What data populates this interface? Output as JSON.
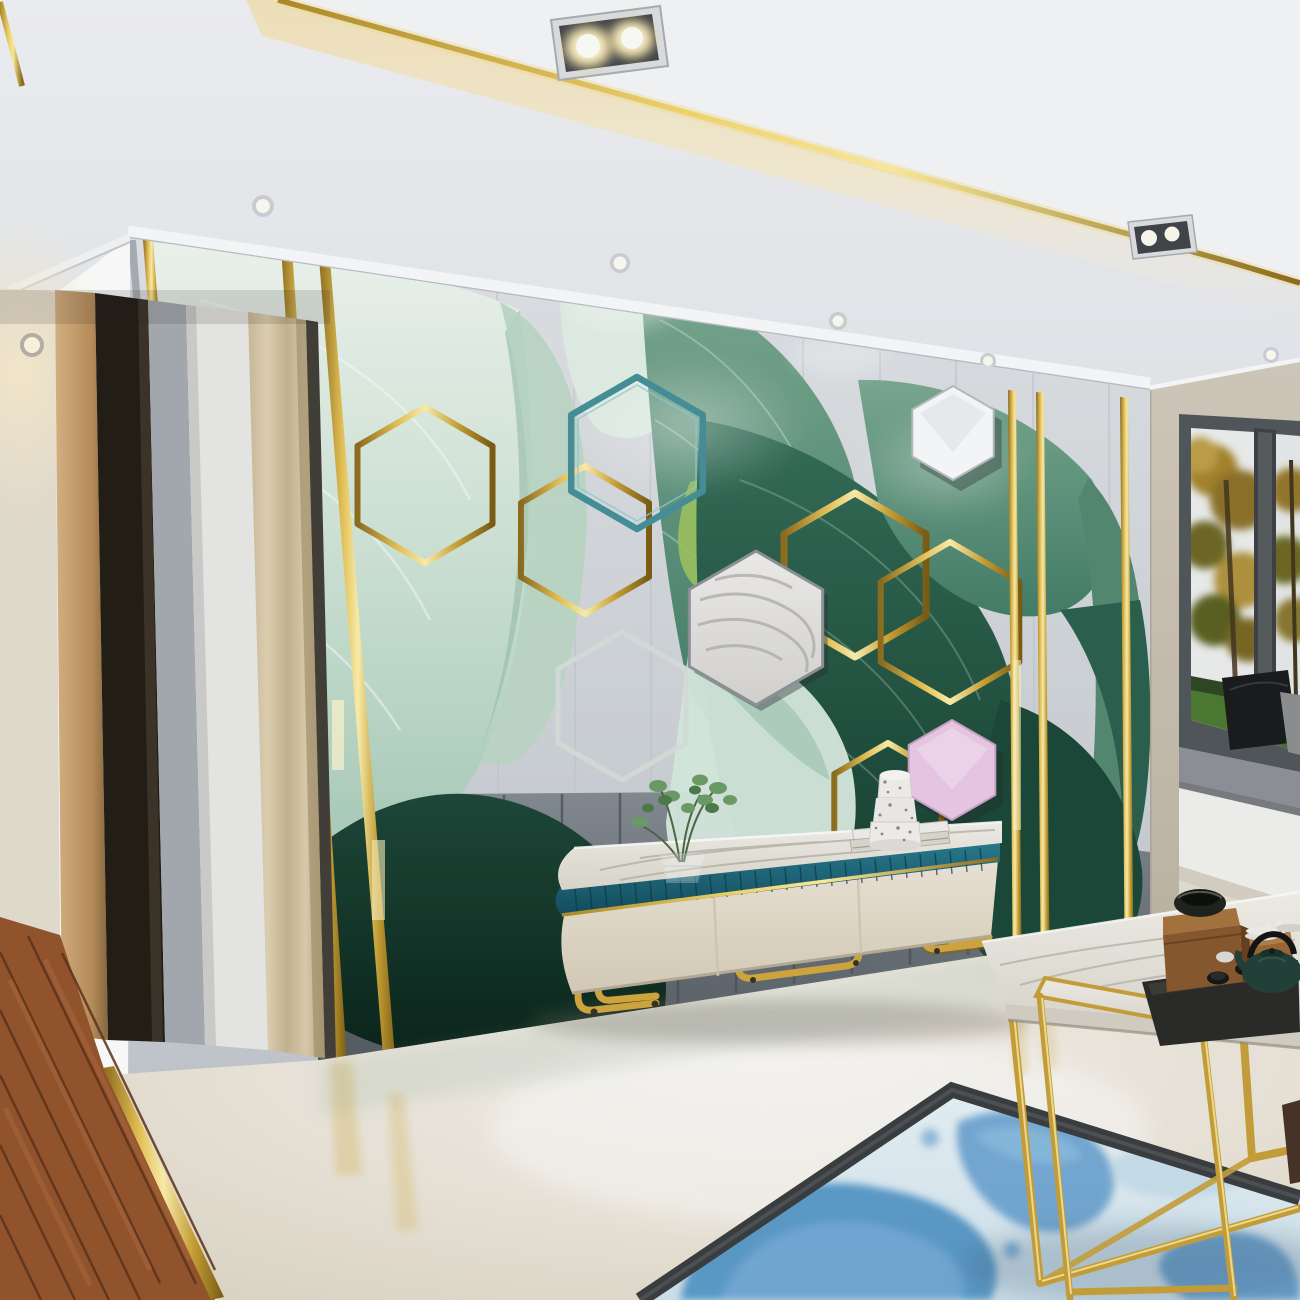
{
  "scene": {
    "type": "interior-3d-render",
    "room": "living-room",
    "label": "Modern living room with 3D tropical leaf feature wall, gold hexagon decor, marble TV console, nesting gold coffee tables, watercolor rug and bay window"
  },
  "palette": {
    "gold": "#d4a93f",
    "gold_bright": "#fff2ae",
    "ceiling_white": "#f2f3f5",
    "cove_warm": "#f5e6bf",
    "wall_panel_gray": "#d9dce0",
    "wall_lower_gray": "#6d747c",
    "leaf_mint": "#cfe6d8",
    "leaf_green": "#4a8169",
    "leaf_dark_green": "#16392d",
    "hex_teal": "#47929b",
    "hex_pink": "#eccbe9",
    "hex_marble": "#eceae6",
    "console_teal": "#1f6b7e",
    "console_cream": "#e9e2d4",
    "floor_marble": "#efe9dd",
    "floor_wood": "#96562e",
    "rug_field": "#e7f2f7",
    "rug_blue": "#4f93c8",
    "rug_border": "#3b3f42",
    "window_frame": "#53585c",
    "autumn_tree": "#a8862f",
    "lawn_green": "#4e7c33",
    "greige_wall": "#cec6b8",
    "curtain_tan": "#d8c8a8"
  },
  "objects": {
    "ceiling": {
      "label": "White tray ceiling with gold trim and warm cove lighting"
    },
    "spotlights": {
      "label": "Recessed chrome double spotlight fixtures"
    },
    "downlights": {
      "label": "Round recessed ceiling downlights"
    },
    "hallway": {
      "label": "Side hallway with beige wall, wooden door frame and pleated curtain panel"
    },
    "feature_wall": {
      "label": "Gray paneled feature wall with 3D green banana leaf mural"
    },
    "leaves": {
      "label": "Sculpted mint and deep green banana leaves"
    },
    "hexagons": {
      "label": "Teal, gold, white marble and pink hexagon wall decor"
    },
    "gold_strips": {
      "label": "Vertical polished brass inlay strips"
    },
    "tv_console": {
      "label": "Marble top TV console with teal fluted band, cream drawers and gold tube legs"
    },
    "console_decor": {
      "label": "Glass vase with green sprigs, stacked books and speckled terrazzo jar"
    },
    "window": {
      "label": "Bay window with dark frame, gray seat cushion, black pillows and autumn garden view"
    },
    "floor": {
      "label": "Polished cream marble floor"
    },
    "wood_floor": {
      "label": "Walnut plank hallway floor with brass transition strip"
    },
    "rug": {
      "label": "Light blue watercolor area rug with dark border"
    },
    "coffee_tables": {
      "label": "Nesting gold frame marble coffee tables"
    },
    "tea_set": {
      "label": "Dark tea tray with green teapot, cups, wooden boxes and black bowl"
    }
  }
}
